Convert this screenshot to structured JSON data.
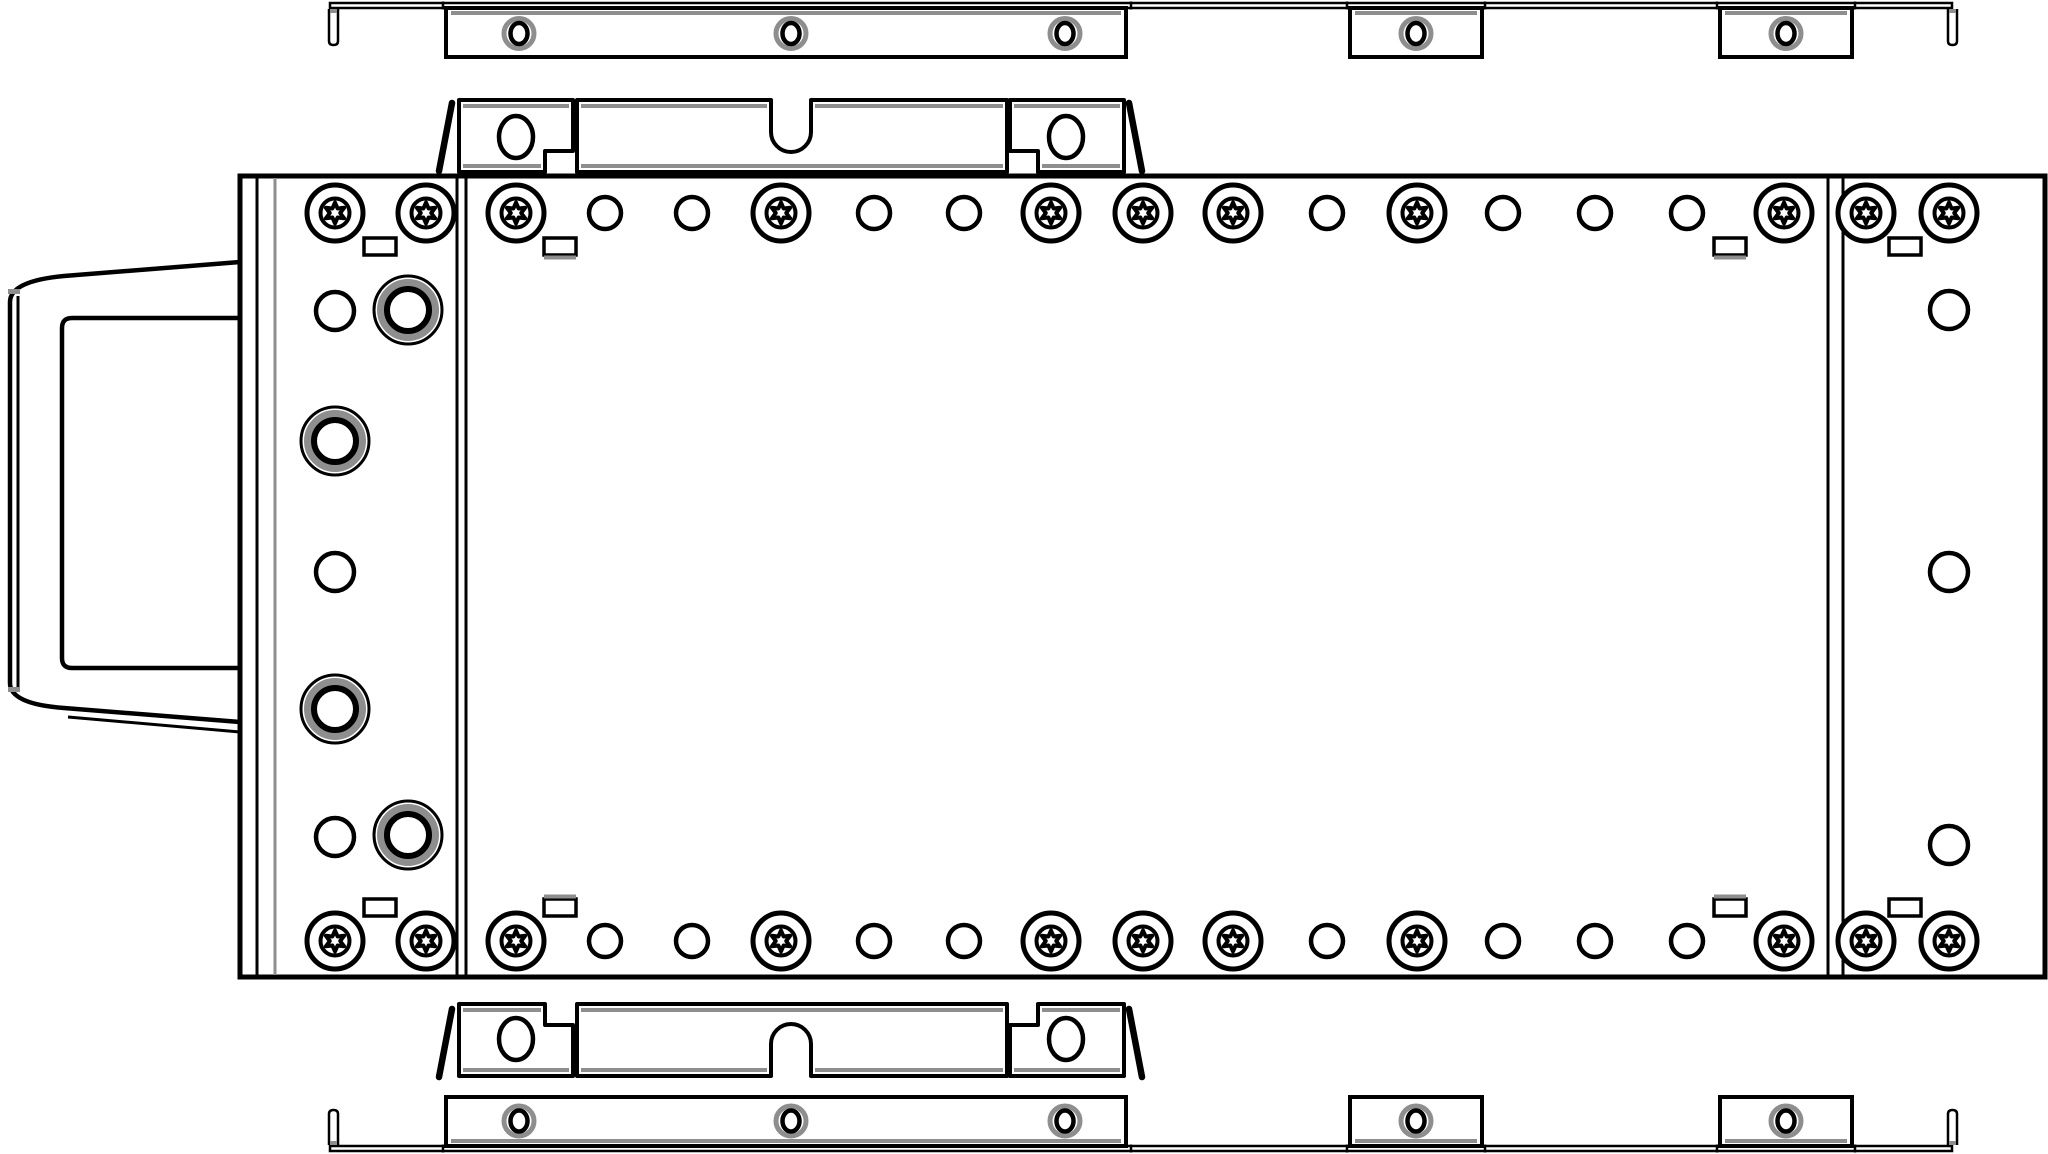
{
  "meta": {
    "title": "Exploded assembly line drawing",
    "description": "Black-and-white technical exploded view: rack-mount chassis plate with front bezel, upper and lower mounting rails and two retention brackets, fastened with torx screws, rivet holes and rubber grommets"
  },
  "colors": {
    "ink": "#000000",
    "accent": "#8e8e8e",
    "paper": "#ffffff"
  },
  "parts": [
    {
      "id": "top-rail",
      "label": "top mounting rail"
    },
    {
      "id": "top-bracket",
      "label": "upper retention bracket"
    },
    {
      "id": "chassis",
      "label": "main chassis plate"
    },
    {
      "id": "front-bezel",
      "label": "front bezel handle"
    },
    {
      "id": "bottom-bracket",
      "label": "lower retention bracket"
    },
    {
      "id": "bottom-rail",
      "label": "bottom mounting rail"
    }
  ],
  "rails": {
    "band_x": [
      330,
      1952
    ],
    "sections": [
      [
        446,
        1126
      ],
      [
        1350,
        1482
      ],
      [
        1720,
        1852
      ]
    ],
    "hole_cx": [
      519,
      791,
      1065,
      1416,
      1786
    ],
    "ticks": [
      443,
      1131,
      1347,
      1485,
      1717,
      1855
    ],
    "hook_x_left": 329,
    "hook_x_right": 1948,
    "hook_w": 9,
    "hole_r_outer": 15,
    "hole_rx": 8.5,
    "hole_ry": 10.5,
    "top": {
      "band": [
        3,
        8
      ],
      "deep": [
        8,
        57
      ],
      "holeCy": 33.5,
      "accent": 13,
      "hook": [
        9,
        45
      ]
    },
    "bottom": {
      "band": [
        1146,
        1151
      ],
      "deep": [
        1097,
        1146
      ],
      "holeCy": 1121,
      "accent": 1141,
      "hook": [
        1145,
        1110
      ]
    }
  },
  "brackets": {
    "x": {
      "box_l": [
        459,
        573
      ],
      "main": [
        577,
        1007
      ],
      "box_r": [
        1010,
        1124
      ],
      "notch_l": 545,
      "notch_r": 1038,
      "u_center": 791,
      "u_half": 20
    },
    "hole_cx": [
      516,
      1066
    ],
    "hole_rx": 17,
    "hole_ry": 21,
    "top": {
      "y0": 100,
      "y1": 172,
      "step_y": 151,
      "u_shoulder": 132,
      "hole_cy": 137
    },
    "mirror_T": 1176,
    "pins_top": [
      [
        452,
        103,
        439,
        171
      ],
      [
        1129,
        103,
        1142,
        171
      ]
    ],
    "pins_bottom": [
      [
        452,
        1009,
        439,
        1077
      ],
      [
        1129,
        1009,
        1142,
        1077
      ]
    ]
  },
  "chassis": {
    "outer": {
      "x": 240,
      "y": 176,
      "x2": 2045,
      "y2": 977
    },
    "left_line_black": 257,
    "left_line_gray": 275,
    "dividers": [
      457,
      466,
      1828,
      1843
    ],
    "rows": {
      "top_cy": 213,
      "bottom_cy": 941,
      "torx_cx": [
        335,
        426,
        516,
        781,
        1051,
        1143,
        1233,
        1417,
        1784,
        1866,
        1949
      ],
      "plain_cx": [
        605,
        692,
        874,
        964,
        1327,
        1503,
        1595,
        1687
      ],
      "plain_r": 16
    },
    "torx": {
      "r_outer": 28,
      "r_inner": 14.5,
      "star_r1": 10.5,
      "star_r2": 5.2
    },
    "left_col": {
      "plain": [
        [
          335,
          311
        ],
        [
          335,
          572
        ],
        [
          335,
          837
        ]
      ],
      "grommets": [
        [
          408,
          310
        ],
        [
          335,
          441
        ],
        [
          335,
          709
        ],
        [
          408,
          835
        ]
      ],
      "plain_r": 19
    },
    "right_col_plain": [
      [
        1949,
        310
      ],
      [
        1949,
        572
      ],
      [
        1949,
        845
      ]
    ],
    "grommet": {
      "r1": 34,
      "r2": 26.5,
      "r3": 21
    },
    "slots": {
      "cx": [
        380,
        560,
        1730,
        1905
      ],
      "accented": [
        false,
        true,
        true,
        false
      ],
      "top_y": 238,
      "bottom_y": 899,
      "w": 32,
      "h": 17
    }
  },
  "bezel": {
    "top_edge": [
      [
        240,
        262
      ],
      [
        64,
        276
      ]
    ],
    "bottom_edge": [
      [
        240,
        722
      ],
      [
        64,
        708
      ]
    ],
    "bottom_inner": [
      [
        240,
        732
      ],
      [
        68,
        717
      ]
    ],
    "left_x": 10,
    "inner_left_x": 18,
    "left_y": [
      302,
      683
    ],
    "inner_left_y": [
      296,
      689
    ],
    "ticks_y": [
      289,
      687
    ],
    "inner_rect": {
      "x": 62,
      "y": 318,
      "right": 240,
      "bottom": 668,
      "r": 10
    }
  }
}
